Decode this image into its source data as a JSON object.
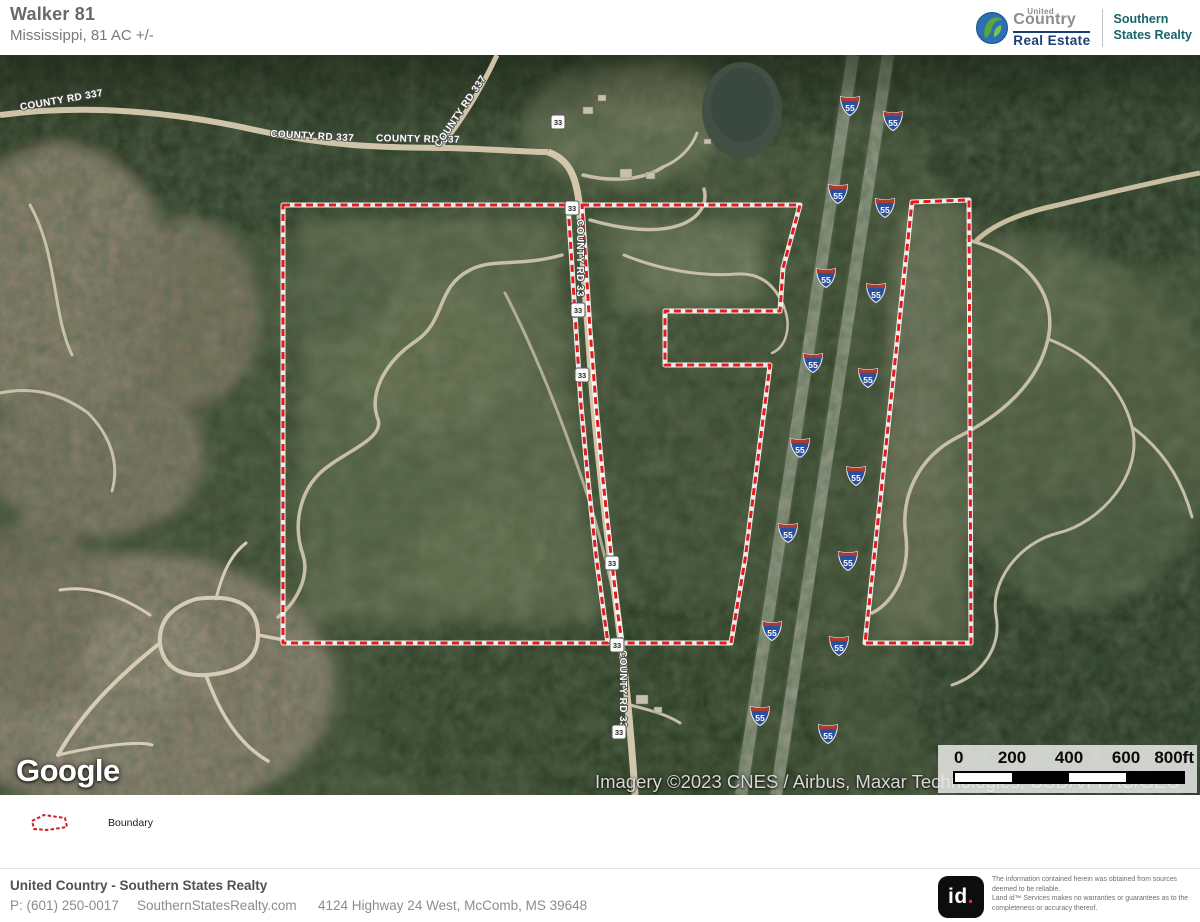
{
  "header": {
    "title": "Walker 81",
    "subtitle": "Mississippi, 81 AC +/-",
    "brand": {
      "united": "United",
      "country": "Country",
      "real_estate": "Real Estate",
      "partner_line1": "Southern",
      "partner_line2": "States Realty"
    }
  },
  "map": {
    "google_logo": "Google",
    "attribution": "Imagery ©2023 CNES / Airbus, Maxar Technologies, USDA/FPAC/GEO",
    "scale_labels": [
      "0",
      "200",
      "400",
      "600",
      "800ft"
    ],
    "road_labels": [
      {
        "text": "COUNTY RD 337",
        "x": 62,
        "y": 48,
        "rotate": -10
      },
      {
        "text": "COUNTY RD 337",
        "x": 312,
        "y": 84,
        "rotate": 3
      },
      {
        "text": "COUNTY RD 337",
        "x": 418,
        "y": 87,
        "rotate": 1
      },
      {
        "text": "COUNTY RD 337",
        "x": 463,
        "y": 58,
        "rotate": -56
      },
      {
        "text": "COUNTY RD 33",
        "x": 577,
        "y": 203,
        "rotate": 90
      },
      {
        "text": "COUNTY RD 33",
        "x": 620,
        "y": 634,
        "rotate": 90
      }
    ],
    "shields": {
      "interstate": {
        "label": "55",
        "positions": [
          [
            850,
            50
          ],
          [
            838,
            138
          ],
          [
            826,
            222
          ],
          [
            813,
            307
          ],
          [
            800,
            392
          ],
          [
            788,
            477
          ],
          [
            772,
            575
          ],
          [
            760,
            660
          ],
          [
            893,
            65
          ],
          [
            885,
            152
          ],
          [
            876,
            237
          ],
          [
            868,
            322
          ],
          [
            856,
            420
          ],
          [
            848,
            505
          ],
          [
            839,
            590
          ],
          [
            828,
            678
          ]
        ]
      },
      "county": {
        "label": "33",
        "positions": [
          [
            558,
            67
          ],
          [
            572,
            153
          ],
          [
            578,
            255
          ],
          [
            582,
            320
          ],
          [
            612,
            508
          ],
          [
            617,
            590
          ],
          [
            619,
            677
          ]
        ]
      }
    },
    "boundary": {
      "color": "#e31b1e",
      "west_points": "283,150 568,150 571,195 576,275 581,350 588,425 596,500 604,560 608,588 283,588",
      "east_points": "582,150 800,150 783,213 780,256 665,256 665,310 770,310 745,505 731,588 622,588 618,560 611,500 603,425 596,350 590,275 585,195",
      "right_points": "912,147 969,145 971,588 865,588"
    }
  },
  "legend": {
    "boundary_label": "Boundary"
  },
  "footer": {
    "company": "United Country - Southern States Realty",
    "phone": "P: (601) 250-0017",
    "website": "SouthernStatesRealty.com",
    "address": "4124 Highway 24 West, McComb, MS 39648",
    "landid": {
      "logo_id": "id",
      "logo_dot": ".",
      "disclaimer_line1": "The information contained herein was obtained from sources deemed to be reliable.",
      "disclaimer_line2": "Land id™ Services makes no warranties or guarantees as to the completeness or accuracy thereof."
    }
  }
}
